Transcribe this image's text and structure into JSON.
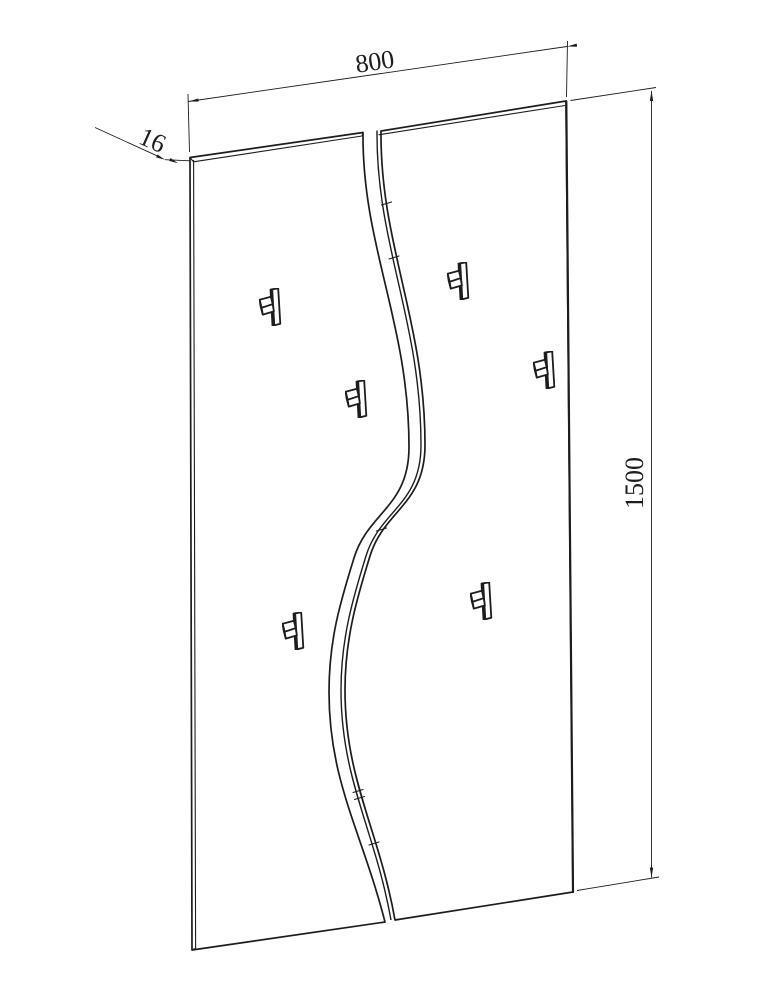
{
  "colors": {
    "background": "#ffffff",
    "line": "#1d1d1d"
  },
  "drawing": {
    "type": "technical-outline-drawing",
    "subject": "wall coat rack: two vertical panels separated by an S-curve split, with six coat hooks",
    "dimensions": {
      "width": "800",
      "thickness": "16",
      "height": "1500"
    },
    "hooks": {
      "count": "6"
    }
  }
}
